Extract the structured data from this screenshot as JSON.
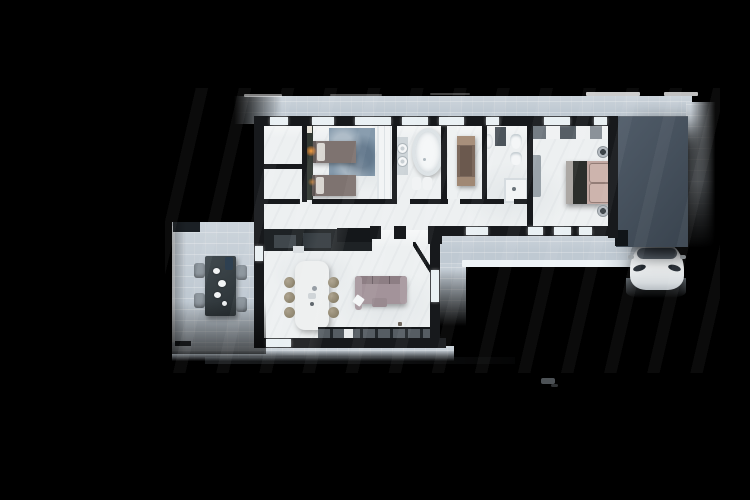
{
  "meta": {
    "title": "Top-down 3D rendered floor plan of an L-shaped single-storey house with terrace, carport and white car on a black background",
    "canvas": {
      "width": 750,
      "height": 500
    }
  },
  "palette": {
    "bg": "#000000",
    "tile": "#bfc9d2",
    "floor": "#edf0f1",
    "wall": "#17191c",
    "glass": "#e9f0f3",
    "carport1": "#505c69",
    "carport2": "#39434e",
    "carbody": "#f1f3f4",
    "olive": "#333a34",
    "rug": "#8499ab",
    "twinbed": "#7e7370",
    "pillow": "#d9d6d1",
    "wardrobe": "#f2f4f5",
    "tub": "#f5f7f8",
    "brown": "#7c695d",
    "brownarm": "#a78f7b",
    "duvet": "#c2a8a2",
    "throw": "#2b2e2b",
    "bench": "#9aa3aa",
    "island": "#edefef",
    "stool": "#7f765f",
    "sofa": "#a3939a",
    "counter": "#1e2225",
    "cabinets": "#565d63",
    "table": "#2a3135",
    "chair": "#8a939b",
    "lampGlow": "#ff9a3a"
  },
  "scene": {
    "view": "top-down architectural render, no visible text labels",
    "outdoor": {
      "terrace_tiled": true,
      "dining_set": {
        "tables": 1,
        "chairs": 4,
        "tabletop_items": [
          "plates",
          "dark bottle"
        ]
      },
      "planters": 2,
      "carport": {
        "color": "dark slate",
        "posts": 1
      },
      "car": {
        "color": "white",
        "position": "nose visible below carport roof"
      }
    },
    "rooms": [
      {
        "name": "entry-closets",
        "furniture": []
      },
      {
        "name": "twin-bedroom",
        "furniture": [
          "twin bed",
          "twin bed",
          "lit bedside lamp",
          "blue area rug",
          "wardrobe",
          "dark accent wall"
        ]
      },
      {
        "name": "bathroom-1",
        "furniture": [
          "freestanding oval tub",
          "round sink",
          "round sink",
          "bath mat",
          "bath mat",
          "vanity counter"
        ]
      },
      {
        "name": "study",
        "furniture": [
          "brown sofa",
          "white cabinet"
        ]
      },
      {
        "name": "bathroom-2",
        "furniture": [
          "toilet",
          "bidet",
          "walk-in shower",
          "sink",
          "wall shelf"
        ]
      },
      {
        "name": "master-bedroom",
        "furniture": [
          "double bed with mauve duvet and dark throw",
          "closet row",
          "bench",
          "round side lamp",
          "round side lamp"
        ]
      },
      {
        "name": "living-kitchen",
        "furniture": [
          "dark kitchen counter run",
          "white island",
          "bar stools x6",
          "mauve sofa with white throw",
          "lower cabinet row",
          "open interior door"
        ]
      }
    ]
  }
}
